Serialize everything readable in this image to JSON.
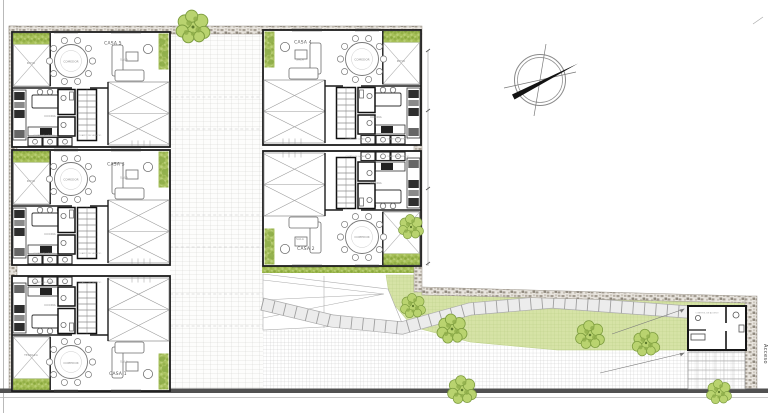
{
  "houses": [
    {
      "label": "CASA 1"
    },
    {
      "label": "CASA 2"
    },
    {
      "label": "CASA 3"
    },
    {
      "label": "CASA 4"
    },
    {
      "label": "CASA 5"
    }
  ],
  "rooms": {
    "dining": "COMEDOR",
    "living": "SALA",
    "kitchen": "COCINA",
    "patio": "PATIO",
    "terrace": "TERRAZA",
    "laundry": "CUARTO DE LAVADO",
    "service": "CUARTO DE SERVICIO",
    "control": "CONTROL DE ACCESO"
  },
  "site": {
    "access_label": "Acceso"
  },
  "colors": {
    "tree_green": "#b9d36f",
    "hedge_green": "#a6bf58",
    "lawn_green": "#d6e3a6",
    "stone_wall": "#a49d92",
    "boundary_line": "#515151"
  }
}
